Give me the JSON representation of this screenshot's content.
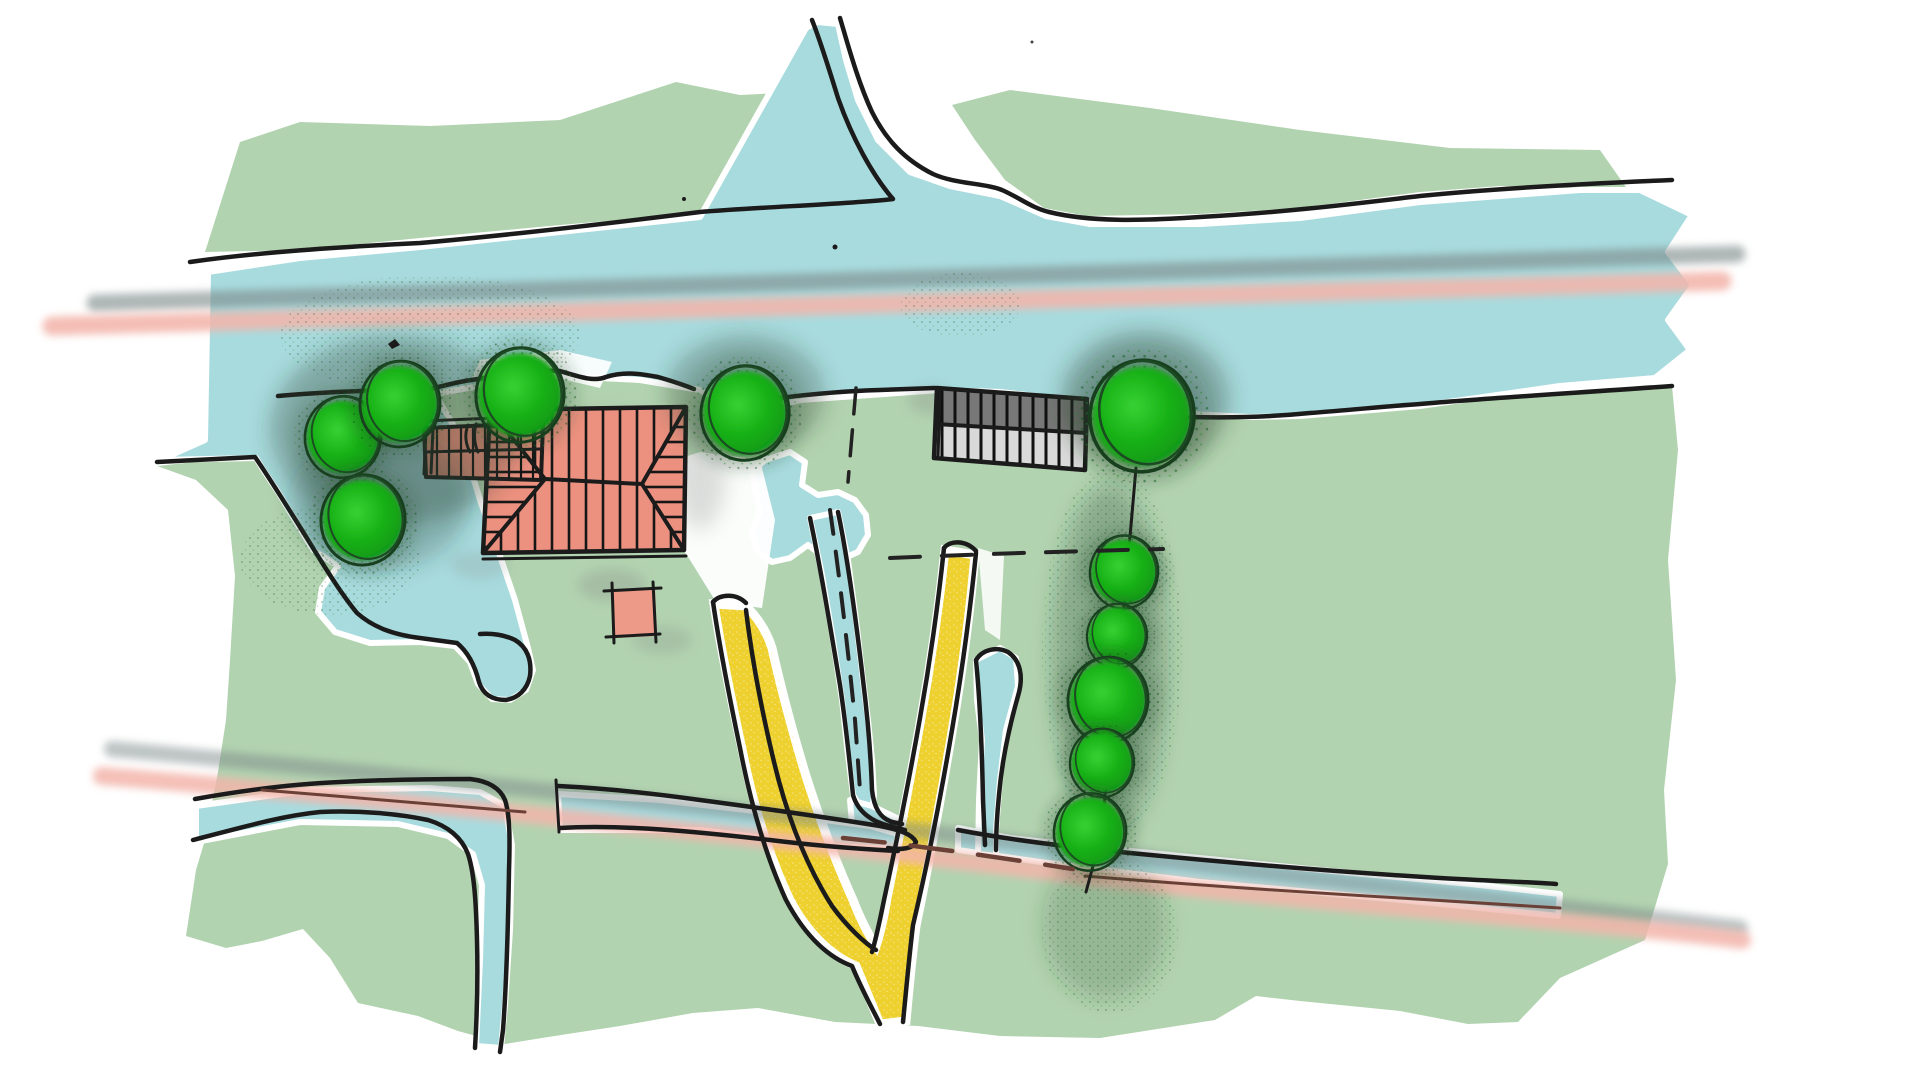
{
  "title": "Hand-drawn landscape site plan sketch",
  "colors": {
    "background": "#ffffff",
    "field_green": "#b2d3b0",
    "water_blue": "#a8dbde",
    "roof_salmon": "#ec9180",
    "shed_salmon": "#ee9a89",
    "barn_dark_gray": "#787878",
    "barn_light_gray": "#d9d9d9",
    "path_yellow": "#eed02e",
    "path_yellow_speck": "#f8eca9",
    "road_pink": "#f3b5ab",
    "road_gray": "#7e8a8a",
    "tree_core_green": "#17b116",
    "tree_halo_green": "#2a482e",
    "tree_outline_green": "#183f1d",
    "ditch_maroon": "#6b4036",
    "sketch_black": "#1b1b1b"
  },
  "scene": {
    "type": "site-plan-sketch",
    "tree_count": 11,
    "features": [
      "upper-field",
      "main-field",
      "river",
      "river-fork",
      "river-bay-pond",
      "middle-pond",
      "drainage-channel",
      "lower-ditch",
      "right-ditch",
      "farmhouse-roof",
      "farmhouse-wing",
      "garden-shed",
      "barn-roof",
      "yellow-forked-path",
      "tree-cluster-west",
      "tree-middle",
      "tree-row-east",
      "road-line-upper",
      "road-line-lower",
      "boundary-dashed-line"
    ]
  }
}
